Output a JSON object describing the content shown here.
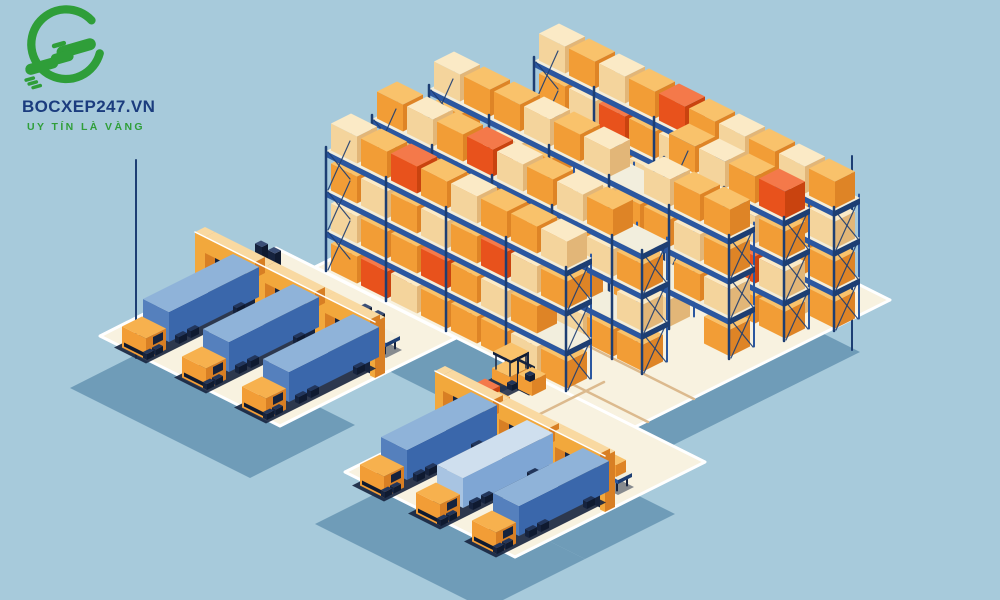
{
  "logo": {
    "brand": "BOCXEP247.VN",
    "tagline": "UY TÍN LÀ VÀNG"
  },
  "palette": {
    "background": "#a7cadb",
    "floor": "#f8f2e0",
    "floor_line": "#dcba8e",
    "ground_shadow": "#6f9cb8",
    "navy": "#16233e",
    "deep_navy": "#0f1a30",
    "rack_blue": "#2b57a0",
    "rack_dark": "#1d3e73",
    "beam_top": "#f2eedd",
    "white": "#ffffff",
    "wall": {
      "top": "#f9d9a1",
      "sw": "#f2a83c",
      "se": "#d87f24"
    },
    "box": {
      "cream": {
        "top": "#fbeac6",
        "sw": "#f4d49c",
        "se": "#e2b678"
      },
      "orange": {
        "top": "#f9c26b",
        "sw": "#f29d36",
        "se": "#de8426"
      },
      "red": {
        "top": "#f4794a",
        "sw": "#e8521c",
        "se": "#c9430f"
      }
    },
    "trailer": {
      "blue": {
        "top": "#8fb3d9",
        "sw": "#5580bd",
        "se": "#3a67ab"
      },
      "lightblue": {
        "top": "#cfdfee",
        "sw": "#a8c4e2",
        "se": "#7fa6d4"
      }
    },
    "cab": {
      "top": "#f7b14e",
      "sw": "#f29d36",
      "se": "#d87f24"
    },
    "slab": {
      "top": "#f2eedd",
      "sw": "#2b57a0",
      "se": "#1d3e73"
    },
    "wheel": {
      "top": "#22365c",
      "sw": "#16233e",
      "se": "#0f1a30"
    },
    "logo_green": "#2f9e39",
    "logo_text": "#1b3c7e",
    "logo_tagline": "#2f9e39"
  },
  "scene": {
    "shadow_offset": [
      -30,
      52
    ],
    "floors": [
      {
        "name": "main-hall-floor",
        "pts": [
          [
            570,
            140
          ],
          [
            890,
            300
          ],
          [
            635,
            427
          ],
          [
            315,
            267
          ]
        ],
        "shadow": true
      },
      {
        "name": "left-dock-platform",
        "pts": [
          [
            276,
            248
          ],
          [
            456,
            338
          ],
          [
            385,
            373
          ],
          [
            205,
            283
          ]
        ],
        "shadow": false
      },
      {
        "name": "left-dock-yard",
        "pts": [
          [
            205,
            283
          ],
          [
            385,
            373
          ],
          [
            280,
            426
          ],
          [
            100,
            336
          ]
        ],
        "shadow": true
      },
      {
        "name": "bottom-dock-platform",
        "pts": [
          [
            535,
            377
          ],
          [
            705,
            462
          ],
          [
            615,
            507
          ],
          [
            445,
            422
          ]
        ],
        "shadow": true
      },
      {
        "name": "bottom-dock-yard",
        "pts": [
          [
            445,
            422
          ],
          [
            615,
            507
          ],
          [
            515,
            557
          ],
          [
            345,
            472
          ]
        ],
        "shadow": true
      }
    ],
    "floor_lines": [
      [
        [
          336,
          266
        ],
        [
          648,
          422
        ]
      ],
      [
        [
          382,
          243
        ],
        [
          694,
          399
        ]
      ],
      [
        [
          398,
          238
        ],
        [
          508,
          183
        ]
      ],
      [
        [
          432,
          256
        ],
        [
          542,
          201
        ]
      ],
      [
        [
          556,
          358
        ],
        [
          466,
          403
        ]
      ],
      [
        [
          604,
          382
        ],
        [
          514,
          427
        ]
      ]
    ],
    "wall_posts": [
      {
        "name": "warehouse-corner-post-left",
        "x": 136,
        "y1": 160,
        "y2": 358
      },
      {
        "name": "warehouse-corner-post-right",
        "x": 852,
        "y1": 156,
        "y2": 350
      }
    ],
    "racks": [
      {
        "name": "rack-row-1",
        "anchor": [
          560,
          168
        ],
        "slots": 10,
        "rows": [
          "cocorococo",
          "ocrocoococ",
          "coocorocoo",
          "ocorocooco"
        ]
      },
      {
        "name": "rack-row-2",
        "anchor": [
          690,
          268
        ],
        "slots": 4,
        "rows": [
          "ocor",
          "roco",
          "oorc",
          "croo"
        ]
      },
      {
        "name": "rack-row-3",
        "anchor": [
          455,
          196
        ],
        "slots": 10,
        "rows": [
          "coococecoo",
          "oecoecooco",
          "eooecoceoc",
          "oceooeoceo"
        ]
      },
      {
        "name": "rack-row-4",
        "anchor": [
          398,
          226
        ],
        "slots": 9,
        "rows": [
          "ocorcocoe",
          "coeooceco",
          "orcoeooec",
          "eoocorcoo"
        ]
      },
      {
        "name": "rack-row-5",
        "anchor": [
          352,
          258
        ],
        "slots": 8,
        "rows": [
          "corocooc",
          "ococorco",
          "coorocoe",
          "orcoooco"
        ]
      }
    ],
    "objects": [
      {
        "type": "forklift",
        "name": "forklift-center",
        "pos": [
          520,
          368
        ],
        "color": "orange",
        "dir": "va",
        "carry": true
      },
      {
        "type": "stack",
        "name": "pallet-stack-center",
        "pos": [
          486,
          398
        ]
      },
      {
        "type": "bench",
        "name": "pallet-stand-middle",
        "pos": [
          360,
          329
        ],
        "posts": 2,
        "cargo": false
      },
      {
        "type": "bench",
        "name": "pallet-stand-left",
        "pos": [
          256,
          266
        ],
        "posts": 2,
        "cargo": false
      },
      {
        "type": "forklift",
        "name": "forklift-left-dock",
        "pos": [
          298,
          300
        ],
        "color": "orange",
        "dir": "vb",
        "carry": false
      },
      {
        "type": "wall",
        "name": "left-dock-wall",
        "start": [
          205,
          283
        ],
        "len": 180,
        "gaps": [
          [
            10,
            60
          ],
          [
            70,
            120
          ],
          [
            130,
            175
          ]
        ]
      },
      {
        "type": "truck",
        "name": "truck-left-1",
        "wall": [
          205,
          283
        ],
        "gap": 10,
        "color": "blue"
      },
      {
        "type": "truck",
        "name": "truck-left-2",
        "wall": [
          205,
          283
        ],
        "gap": 70,
        "color": "blue"
      },
      {
        "type": "truck",
        "name": "truck-left-3",
        "wall": [
          205,
          283
        ],
        "gap": 130,
        "color": "blue"
      },
      {
        "type": "bench",
        "name": "pallet-stand-bottom-right",
        "pos": [
          592,
          466
        ],
        "posts": 0,
        "cargo": true
      },
      {
        "type": "wall",
        "name": "bottom-dock-wall",
        "start": [
          445,
          422
        ],
        "len": 170,
        "gaps": [
          [
            8,
            58
          ],
          [
            64,
            114
          ],
          [
            120,
            165
          ]
        ]
      },
      {
        "type": "truck",
        "name": "truck-bottom-1",
        "wall": [
          445,
          422
        ],
        "gap": 8,
        "color": "blue"
      },
      {
        "type": "truck",
        "name": "truck-bottom-2",
        "wall": [
          445,
          422
        ],
        "gap": 64,
        "color": "lightblue"
      },
      {
        "type": "truck",
        "name": "truck-bottom-3",
        "wall": [
          445,
          422
        ],
        "gap": 120,
        "color": "blue"
      }
    ]
  }
}
